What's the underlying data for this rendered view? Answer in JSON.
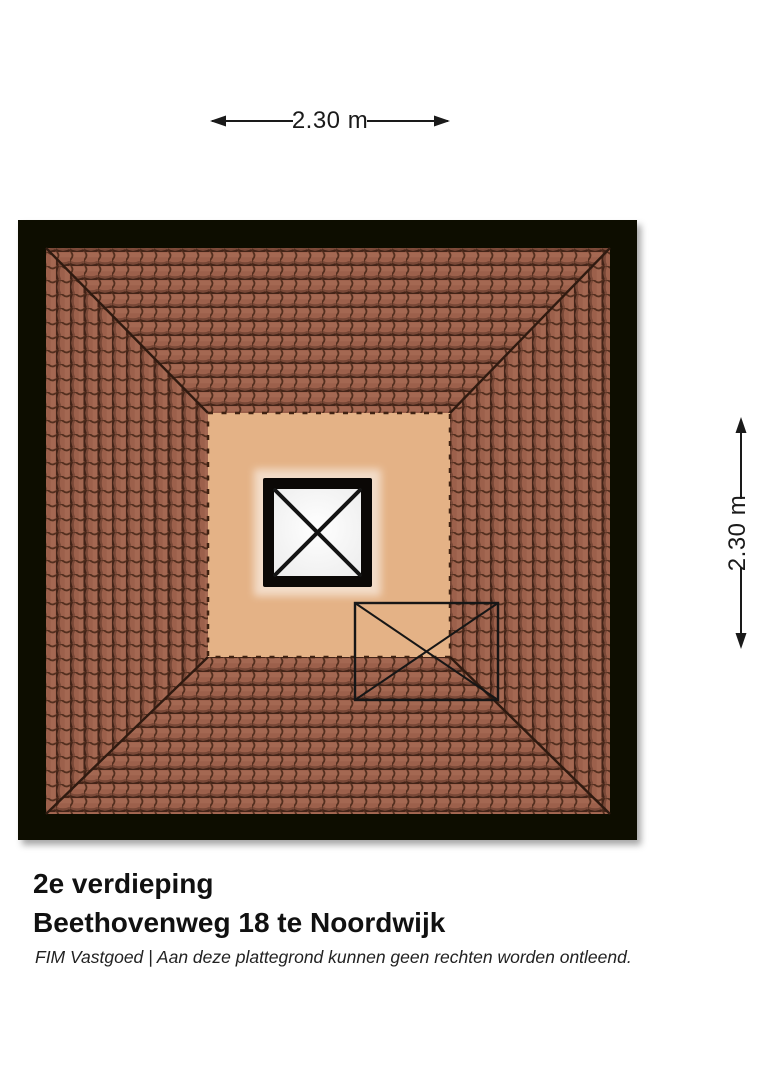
{
  "document": {
    "floor_label": "2e verdieping",
    "address": "Beethovenweg 18 te Noordwijk",
    "disclaimer": "FIM Vastgoed | Aan deze plattegrond kunnen geen rechten worden ontleend."
  },
  "dimensions": {
    "horizontal": "2.30 m",
    "vertical": "2.30 m"
  },
  "plan": {
    "type": "roof-plan-top-view",
    "elements": [
      "hipped-roof-tiles",
      "attic-floor",
      "skylight-with-cross",
      "roof-window-outline"
    ]
  },
  "colors": {
    "background": "#ffffff",
    "ink": "#1a1a1a",
    "frame": "#0b0806",
    "roof_tile": "#9c604b",
    "roof_tile_dark": "#432418",
    "hip_line": "#2f1a10",
    "attic_floor": "#e4b286",
    "attic_dash": "#3f2212",
    "skylight_white": "#fdfdfd",
    "window_line": "#161616"
  }
}
